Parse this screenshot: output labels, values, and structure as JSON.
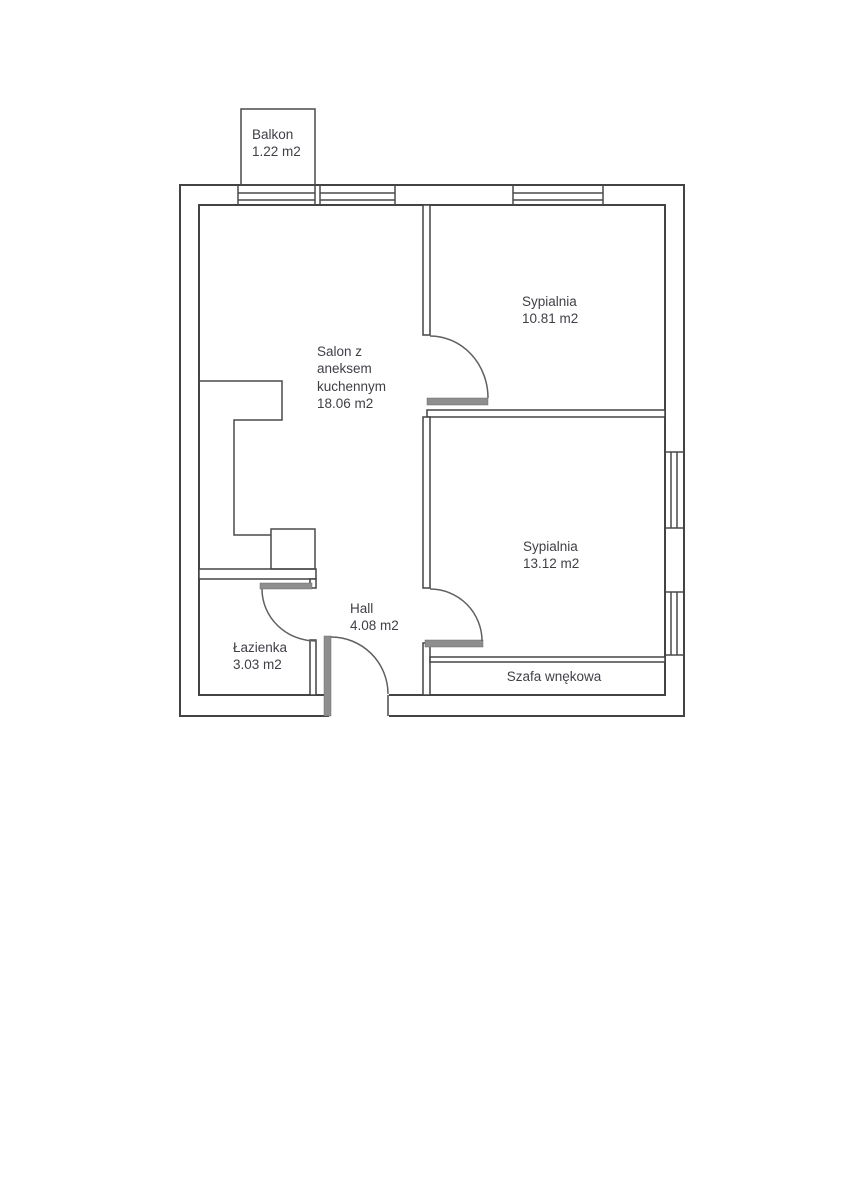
{
  "floorplan": {
    "rooms": [
      {
        "id": "balkon",
        "name": "Balkon",
        "area": "1.22 m2"
      },
      {
        "id": "salon",
        "name": "Salon z aneksem kuchennym",
        "area": "18.06 m2",
        "label_lines": [
          "Salon z",
          "aneksem",
          "kuchennym",
          "18.06 m2"
        ]
      },
      {
        "id": "sypialnia-gorna",
        "name": "Sypialnia",
        "area": "10.81 m2"
      },
      {
        "id": "sypialnia-dolna",
        "name": "Sypialnia",
        "area": "13.12 m2"
      },
      {
        "id": "hall",
        "name": "Hall",
        "area": "4.08 m2"
      },
      {
        "id": "lazienka",
        "name": "Łazienka",
        "area": "3.03 m2"
      },
      {
        "id": "szafa",
        "name": "Szafa wnękowa",
        "area": ""
      }
    ],
    "colors": {
      "background": "#ffffff",
      "wall_line": "#434343",
      "door_leaf": "#8e8e8e",
      "text": "#3f3f47"
    }
  }
}
